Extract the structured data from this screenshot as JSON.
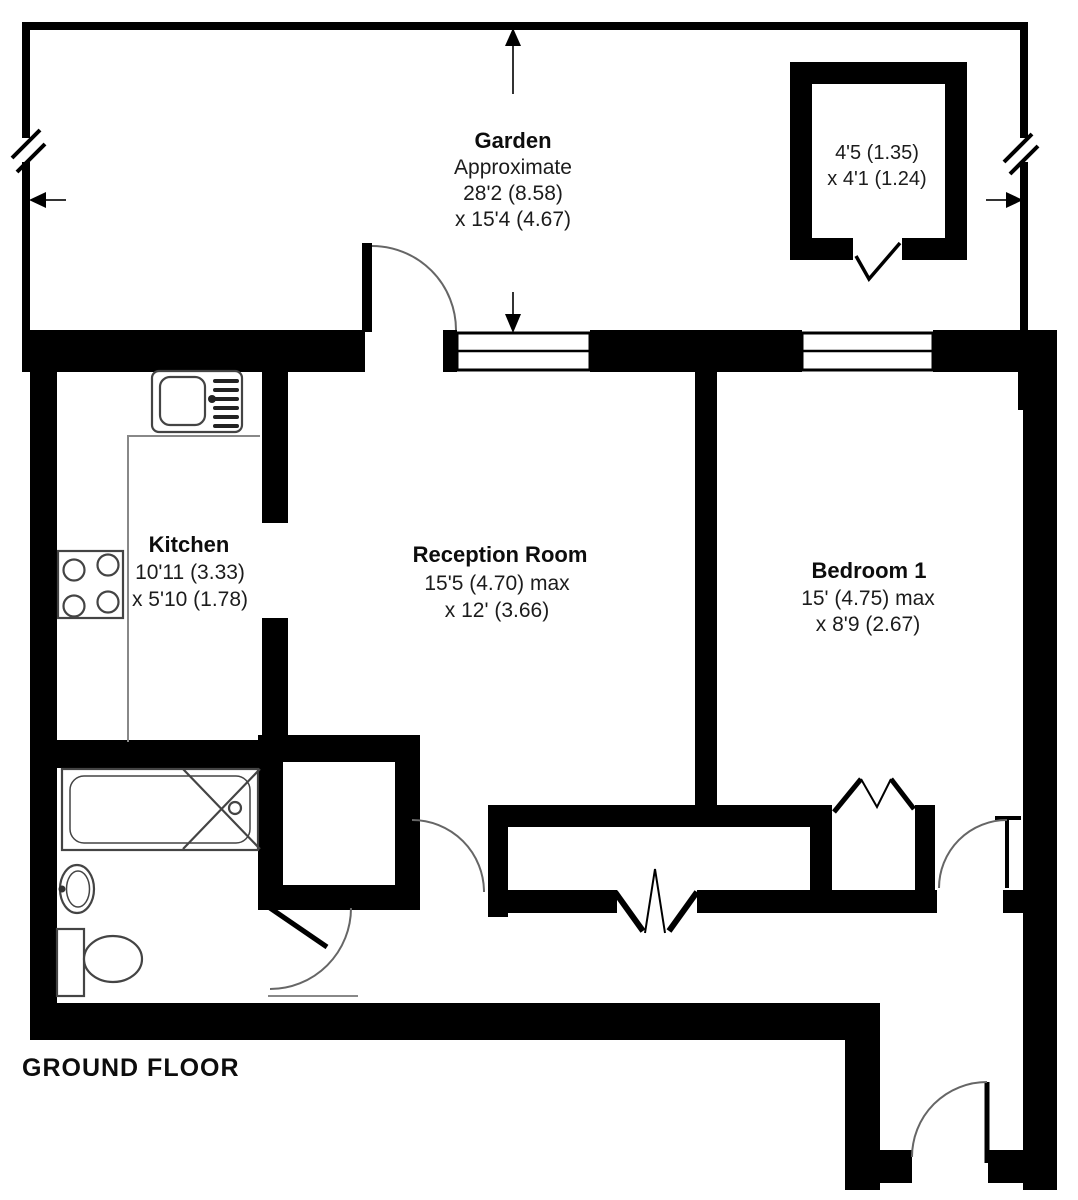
{
  "colors": {
    "wall": "#000000",
    "background": "#ffffff",
    "fixture": "#444444",
    "arc": "#666666",
    "text": "#0d0d0d"
  },
  "floor_label": "GROUND FLOOR",
  "rooms": {
    "garden": {
      "name": "Garden",
      "note": "Approximate",
      "dim1": "28'2 (8.58)",
      "dim2": "x 15'4 (4.67)"
    },
    "shed": {
      "dim1": "4'5 (1.35)",
      "dim2": "x 4'1 (1.24)"
    },
    "kitchen": {
      "name": "Kitchen",
      "dim1": "10'11 (3.33)",
      "dim2": "x 5'10 (1.78)"
    },
    "reception": {
      "name": "Reception Room",
      "dim1": "15'5 (4.70) max",
      "dim2": "x 12' (3.66)"
    },
    "bedroom": {
      "name": "Bedroom 1",
      "dim1": "15' (4.75) max",
      "dim2": "x 8'9 (2.67)"
    }
  }
}
